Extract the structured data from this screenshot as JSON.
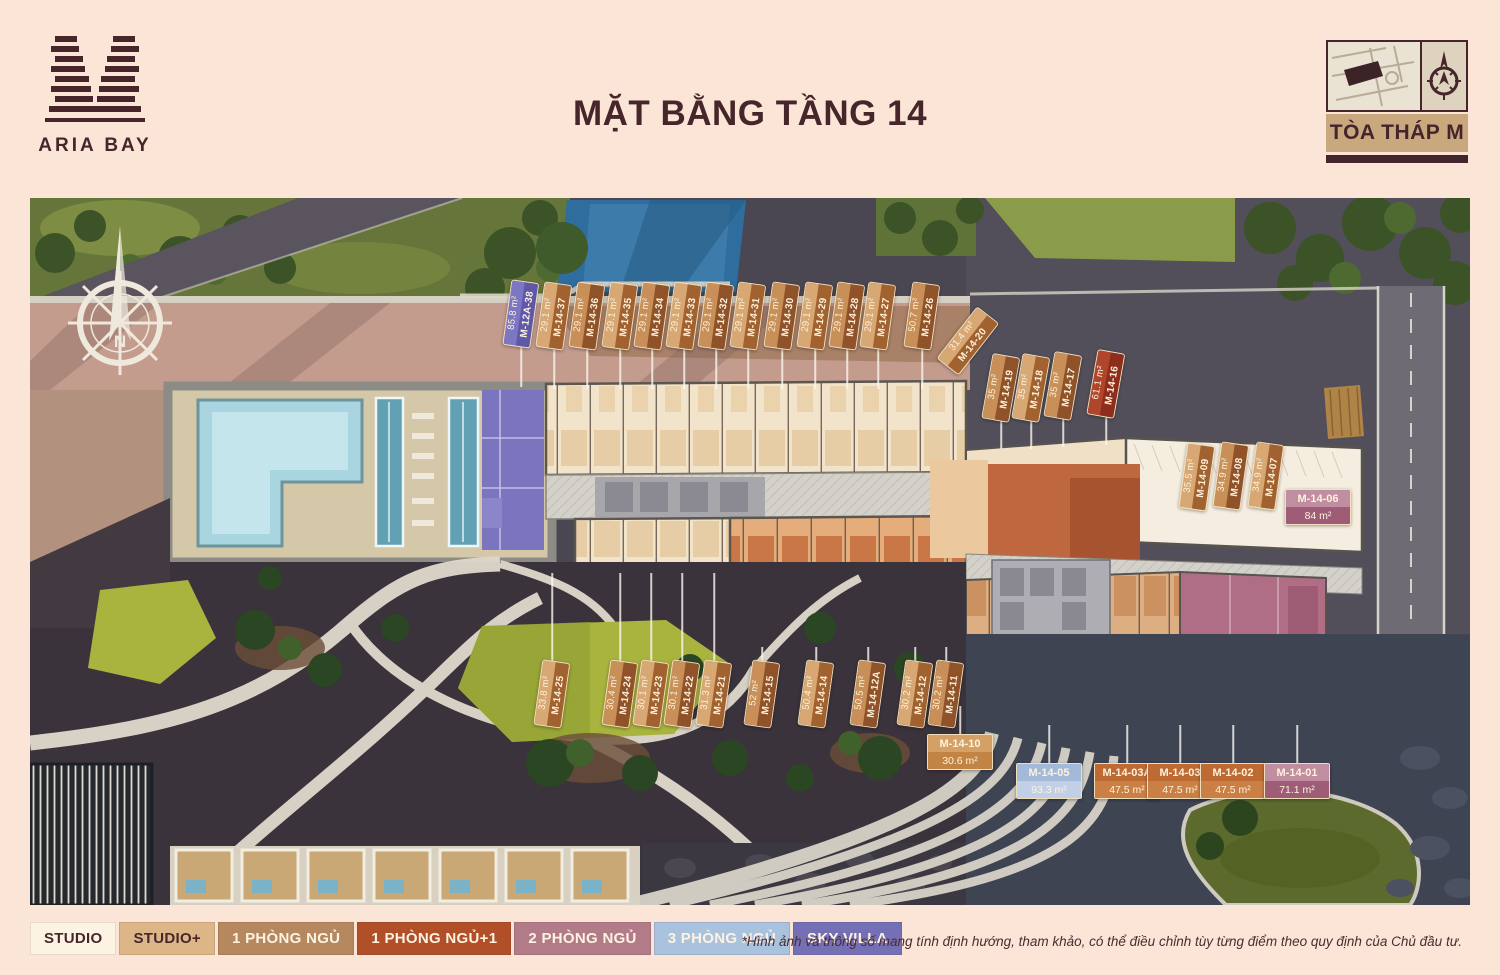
{
  "brand": {
    "name": "ARIA BAY"
  },
  "title": "MẶT BẰNG TẦNG 14",
  "tower_badge": {
    "label": "TÒA THÁP M"
  },
  "compass": {
    "north_label": "N"
  },
  "disclaimer": "*Hình ảnh và thông số mang tính định hướng, tham khảo, có thể điều chỉnh tùy từng điểm theo quy định của Chủ đầu tư.",
  "legend": [
    {
      "label": "STUDIO",
      "bg": "#fdf3e3",
      "fg": "#46262b"
    },
    {
      "label": "STUDIO+",
      "bg": "#dcb687",
      "fg": "#46262b"
    },
    {
      "label": "1 PHÒNG NGỦ",
      "bg": "#b5885f",
      "fg": "#fdf3e3"
    },
    {
      "label": "1 PHÒNG NGỦ+1",
      "bg": "#b04f28",
      "fg": "#fdf3e3"
    },
    {
      "label": "2 PHÒNG NGỦ",
      "bg": "#b17b88",
      "fg": "#fdf3e3"
    },
    {
      "label": "3 PHÒNG NGỦ",
      "bg": "#a9c2de",
      "fg": "#fdf3e3"
    },
    {
      "label": "SKY VILLA",
      "bg": "#7570b6",
      "fg": "#fdf3e3"
    }
  ],
  "units": [
    {
      "id": "M-12A-38",
      "area": "85.8 m²",
      "orient": "v",
      "variant": "u-purple",
      "x": 521,
      "y": 314,
      "rot": 8,
      "leader": 40
    },
    {
      "id": "M-14-37",
      "area": "29.1 m²",
      "orient": "v",
      "variant": "u-tan-a",
      "x": 554,
      "y": 316,
      "rot": 8,
      "leader": 40
    },
    {
      "id": "M-14-36",
      "area": "29.1 m²",
      "orient": "v",
      "variant": "u-tan-b",
      "x": 587,
      "y": 316,
      "rot": 8,
      "leader": 40
    },
    {
      "id": "M-14-35",
      "area": "29.1 m²",
      "orient": "v",
      "variant": "u-tan-a",
      "x": 620,
      "y": 316,
      "rot": 8,
      "leader": 40
    },
    {
      "id": "M-14-34",
      "area": "29.1 m²",
      "orient": "v",
      "variant": "u-tan-b",
      "x": 652,
      "y": 316,
      "rot": 8,
      "leader": 40
    },
    {
      "id": "M-14-33",
      "area": "29.1 m²",
      "orient": "v",
      "variant": "u-tan-a",
      "x": 684,
      "y": 316,
      "rot": 8,
      "leader": 40
    },
    {
      "id": "M-14-32",
      "area": "29.1 m²",
      "orient": "v",
      "variant": "u-tan-b",
      "x": 716,
      "y": 316,
      "rot": 8,
      "leader": 40
    },
    {
      "id": "M-14-31",
      "area": "29.1 m²",
      "orient": "v",
      "variant": "u-tan-a",
      "x": 748,
      "y": 316,
      "rot": 8,
      "leader": 40
    },
    {
      "id": "M-14-30",
      "area": "29.1 m²",
      "orient": "v",
      "variant": "u-tan-b",
      "x": 782,
      "y": 316,
      "rot": 8,
      "leader": 40
    },
    {
      "id": "M-14-29",
      "area": "29.1 m²",
      "orient": "v",
      "variant": "u-tan-a",
      "x": 815,
      "y": 316,
      "rot": 8,
      "leader": 40
    },
    {
      "id": "M-14-28",
      "area": "29.1 m²",
      "orient": "v",
      "variant": "u-tan-b",
      "x": 847,
      "y": 316,
      "rot": 8,
      "leader": 40
    },
    {
      "id": "M-14-27",
      "area": "29.1 m²",
      "orient": "v",
      "variant": "u-tan-a",
      "x": 878,
      "y": 316,
      "rot": 8,
      "leader": 40
    },
    {
      "id": "M-14-26",
      "area": "50.7 m²",
      "orient": "v",
      "variant": "u-tan-b",
      "x": 922,
      "y": 316,
      "rot": 8,
      "leader": 40
    },
    {
      "id": "M-14-20",
      "area": "31.4 m²",
      "orient": "v",
      "variant": "u-tan-a",
      "x": 968,
      "y": 341,
      "rot": 38,
      "leader": 0
    },
    {
      "id": "M-14-19",
      "area": "35 m²",
      "orient": "v",
      "variant": "u-tan-b",
      "x": 1001,
      "y": 388,
      "rot": 10,
      "leader": 28
    },
    {
      "id": "M-14-18",
      "area": "35 m²",
      "orient": "v",
      "variant": "u-tan-a",
      "x": 1031,
      "y": 388,
      "rot": 10,
      "leader": 28
    },
    {
      "id": "M-14-17",
      "area": "35 m²",
      "orient": "v",
      "variant": "u-tan-b",
      "x": 1063,
      "y": 386,
      "rot": 10,
      "leader": 28
    },
    {
      "id": "M-14-16",
      "area": "61.1 m²",
      "orient": "v",
      "variant": "u-red",
      "x": 1106,
      "y": 384,
      "rot": 10,
      "leader": 28
    },
    {
      "id": "M-14-09",
      "area": "35.5 m²",
      "orient": "v",
      "variant": "u-tan-a",
      "x": 1197,
      "y": 477,
      "rot": 8,
      "leader": 0
    },
    {
      "id": "M-14-08",
      "area": "34.9 m²",
      "orient": "v",
      "variant": "u-tan-b",
      "x": 1231,
      "y": 476,
      "rot": 8,
      "leader": 0
    },
    {
      "id": "M-14-07",
      "area": "34.9 m²",
      "orient": "v",
      "variant": "u-tan-a",
      "x": 1266,
      "y": 476,
      "rot": 8,
      "leader": 0
    },
    {
      "id": "M-14-06",
      "area": "84 m²",
      "orient": "h",
      "variant": "h-mauve",
      "x": 1318,
      "y": 507,
      "rot": 0,
      "leader": 0
    },
    {
      "id": "M-14-25",
      "area": "33.8 m²",
      "orient": "v",
      "variant": "u-tan-a",
      "x": 552,
      "y": 694,
      "rot": 8,
      "leader": -88
    },
    {
      "id": "M-14-24",
      "area": "30.4 m²",
      "orient": "v",
      "variant": "u-tan-b",
      "x": 620,
      "y": 694,
      "rot": 8,
      "leader": -88
    },
    {
      "id": "M-14-23",
      "area": "30.1 m²",
      "orient": "v",
      "variant": "u-tan-a",
      "x": 651,
      "y": 694,
      "rot": 8,
      "leader": -88
    },
    {
      "id": "M-14-22",
      "area": "30.1 m²",
      "orient": "v",
      "variant": "u-tan-b",
      "x": 682,
      "y": 694,
      "rot": 8,
      "leader": -88
    },
    {
      "id": "M-14-21",
      "area": "31.3 m²",
      "orient": "v",
      "variant": "u-tan-a",
      "x": 714,
      "y": 694,
      "rot": 8,
      "leader": -88
    },
    {
      "id": "M-14-15",
      "area": "52 m²",
      "orient": "v",
      "variant": "u-tan-b",
      "x": 762,
      "y": 694,
      "rot": 8,
      "leader": -14
    },
    {
      "id": "M-14-14",
      "area": "50.4 m²",
      "orient": "v",
      "variant": "u-tan-a",
      "x": 816,
      "y": 694,
      "rot": 8,
      "leader": -14
    },
    {
      "id": "M-14-12A",
      "area": "50.5 m²",
      "orient": "v",
      "variant": "u-tan-b",
      "x": 868,
      "y": 694,
      "rot": 8,
      "leader": -14
    },
    {
      "id": "M-14-12",
      "area": "30.2 m²",
      "orient": "v",
      "variant": "u-tan-a",
      "x": 915,
      "y": 694,
      "rot": 8,
      "leader": -14
    },
    {
      "id": "M-14-11",
      "area": "30.2 m²",
      "orient": "v",
      "variant": "u-tan-b",
      "x": 946,
      "y": 694,
      "rot": 8,
      "leader": -14
    },
    {
      "id": "M-14-10",
      "area": "30.6 m²",
      "orient": "h",
      "variant": "h-tan",
      "x": 960,
      "y": 752,
      "rot": 0,
      "leader": -30
    },
    {
      "id": "M-14-05",
      "area": "93.3 m²",
      "orient": "h",
      "variant": "h-blue",
      "x": 1049,
      "y": 781,
      "rot": 0,
      "leader": -40
    },
    {
      "id": "M-14-03A",
      "area": "47.5 m²",
      "orient": "h",
      "variant": "h-orange",
      "x": 1127,
      "y": 781,
      "rot": 0,
      "leader": -40
    },
    {
      "id": "M-14-03",
      "area": "47.5 m²",
      "orient": "h",
      "variant": "h-orange",
      "x": 1180,
      "y": 781,
      "rot": 0,
      "leader": -40
    },
    {
      "id": "M-14-02",
      "area": "47.5 m²",
      "orient": "h",
      "variant": "h-orange",
      "x": 1233,
      "y": 781,
      "rot": 0,
      "leader": -40
    },
    {
      "id": "M-14-01",
      "area": "71.1 m²",
      "orient": "h",
      "variant": "h-mauve",
      "x": 1297,
      "y": 781,
      "rot": 0,
      "leader": -40
    }
  ]
}
